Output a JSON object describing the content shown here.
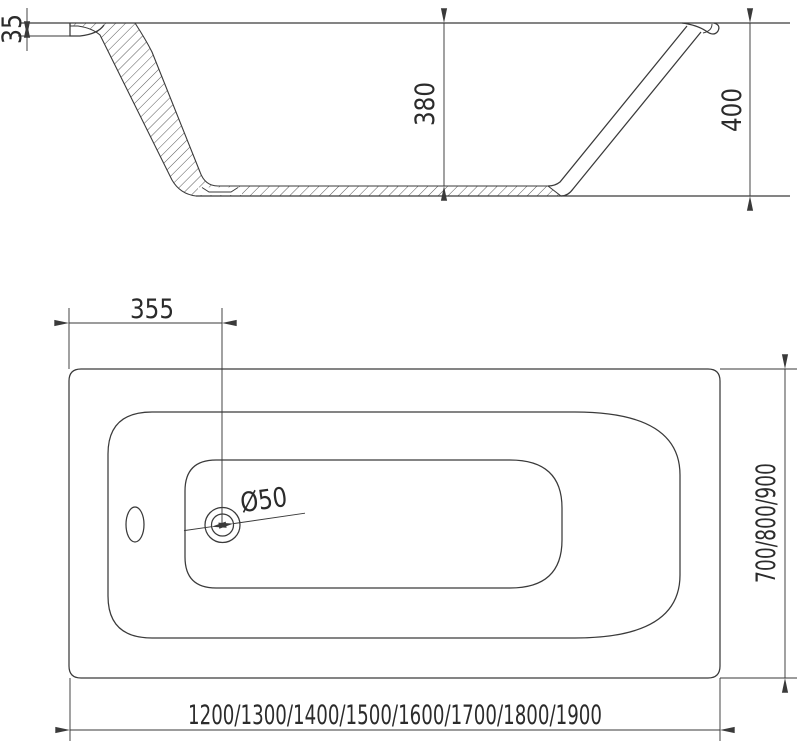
{
  "drawing": {
    "kind": "bathtub technical dimension drawing",
    "views": {
      "side_view": {
        "rim_lip_height": "35",
        "inner_depth": "380",
        "total_height": "400"
      },
      "plan_view": {
        "drain_offset_from_edge": "355",
        "drain_diameter": "Ø50",
        "width_options": "700/800/900",
        "length_options": "1200/1300/1400/1500/1600/1700/1800/1900"
      }
    },
    "colors": {
      "line": "#3a3a3a",
      "text": "#2b2b2b",
      "background": "#ffffff"
    }
  }
}
